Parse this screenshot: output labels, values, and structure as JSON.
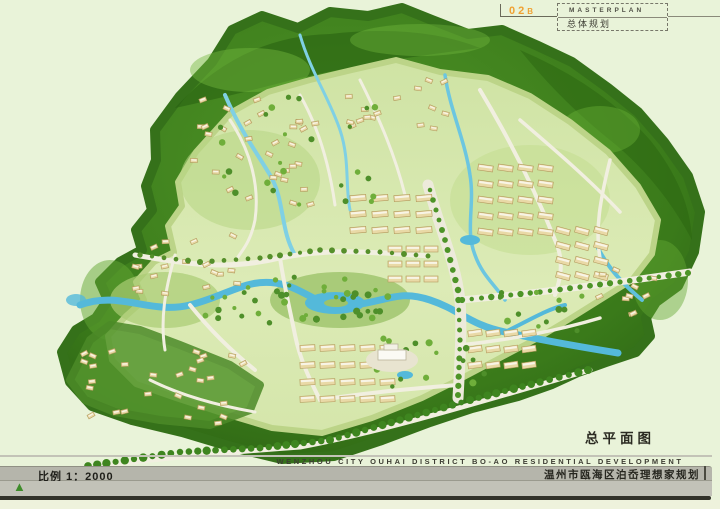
{
  "title_block": {
    "code": "02",
    "code_suffix": "B",
    "title_en": "MASTERPLAN",
    "title_zh": "总体规划"
  },
  "map": {
    "label": "总平面图",
    "features": [
      "forest-hills",
      "streams",
      "central-river",
      "lake",
      "boulevard",
      "residential-blocks",
      "villa-hillside",
      "tree-lined-boundary-road",
      "public-building-plaza"
    ]
  },
  "footer": {
    "scale_label": "比例 1：2000",
    "north_symbol": "▲",
    "project_title_en": "WENZHOU CITY OUHAI DISTRICT BO-AO RESIDENTIAL DEVELOPMENT",
    "project_title_zh": "温州市瓯海区泊岙理想家规划"
  },
  "colors": {
    "page_bg": "#e9f3d9",
    "accent_orange": "#f0a233",
    "forest_dark": "#2e6a14",
    "forest_mid": "#4f9427",
    "forest_light": "#74b93f",
    "development_ground": "#d9e9af",
    "water": "#54b9da",
    "road": "#f1efe0",
    "building": "#e9d9a6",
    "banner_grey": "#b5b5ab",
    "ink": "#3d3d33"
  }
}
